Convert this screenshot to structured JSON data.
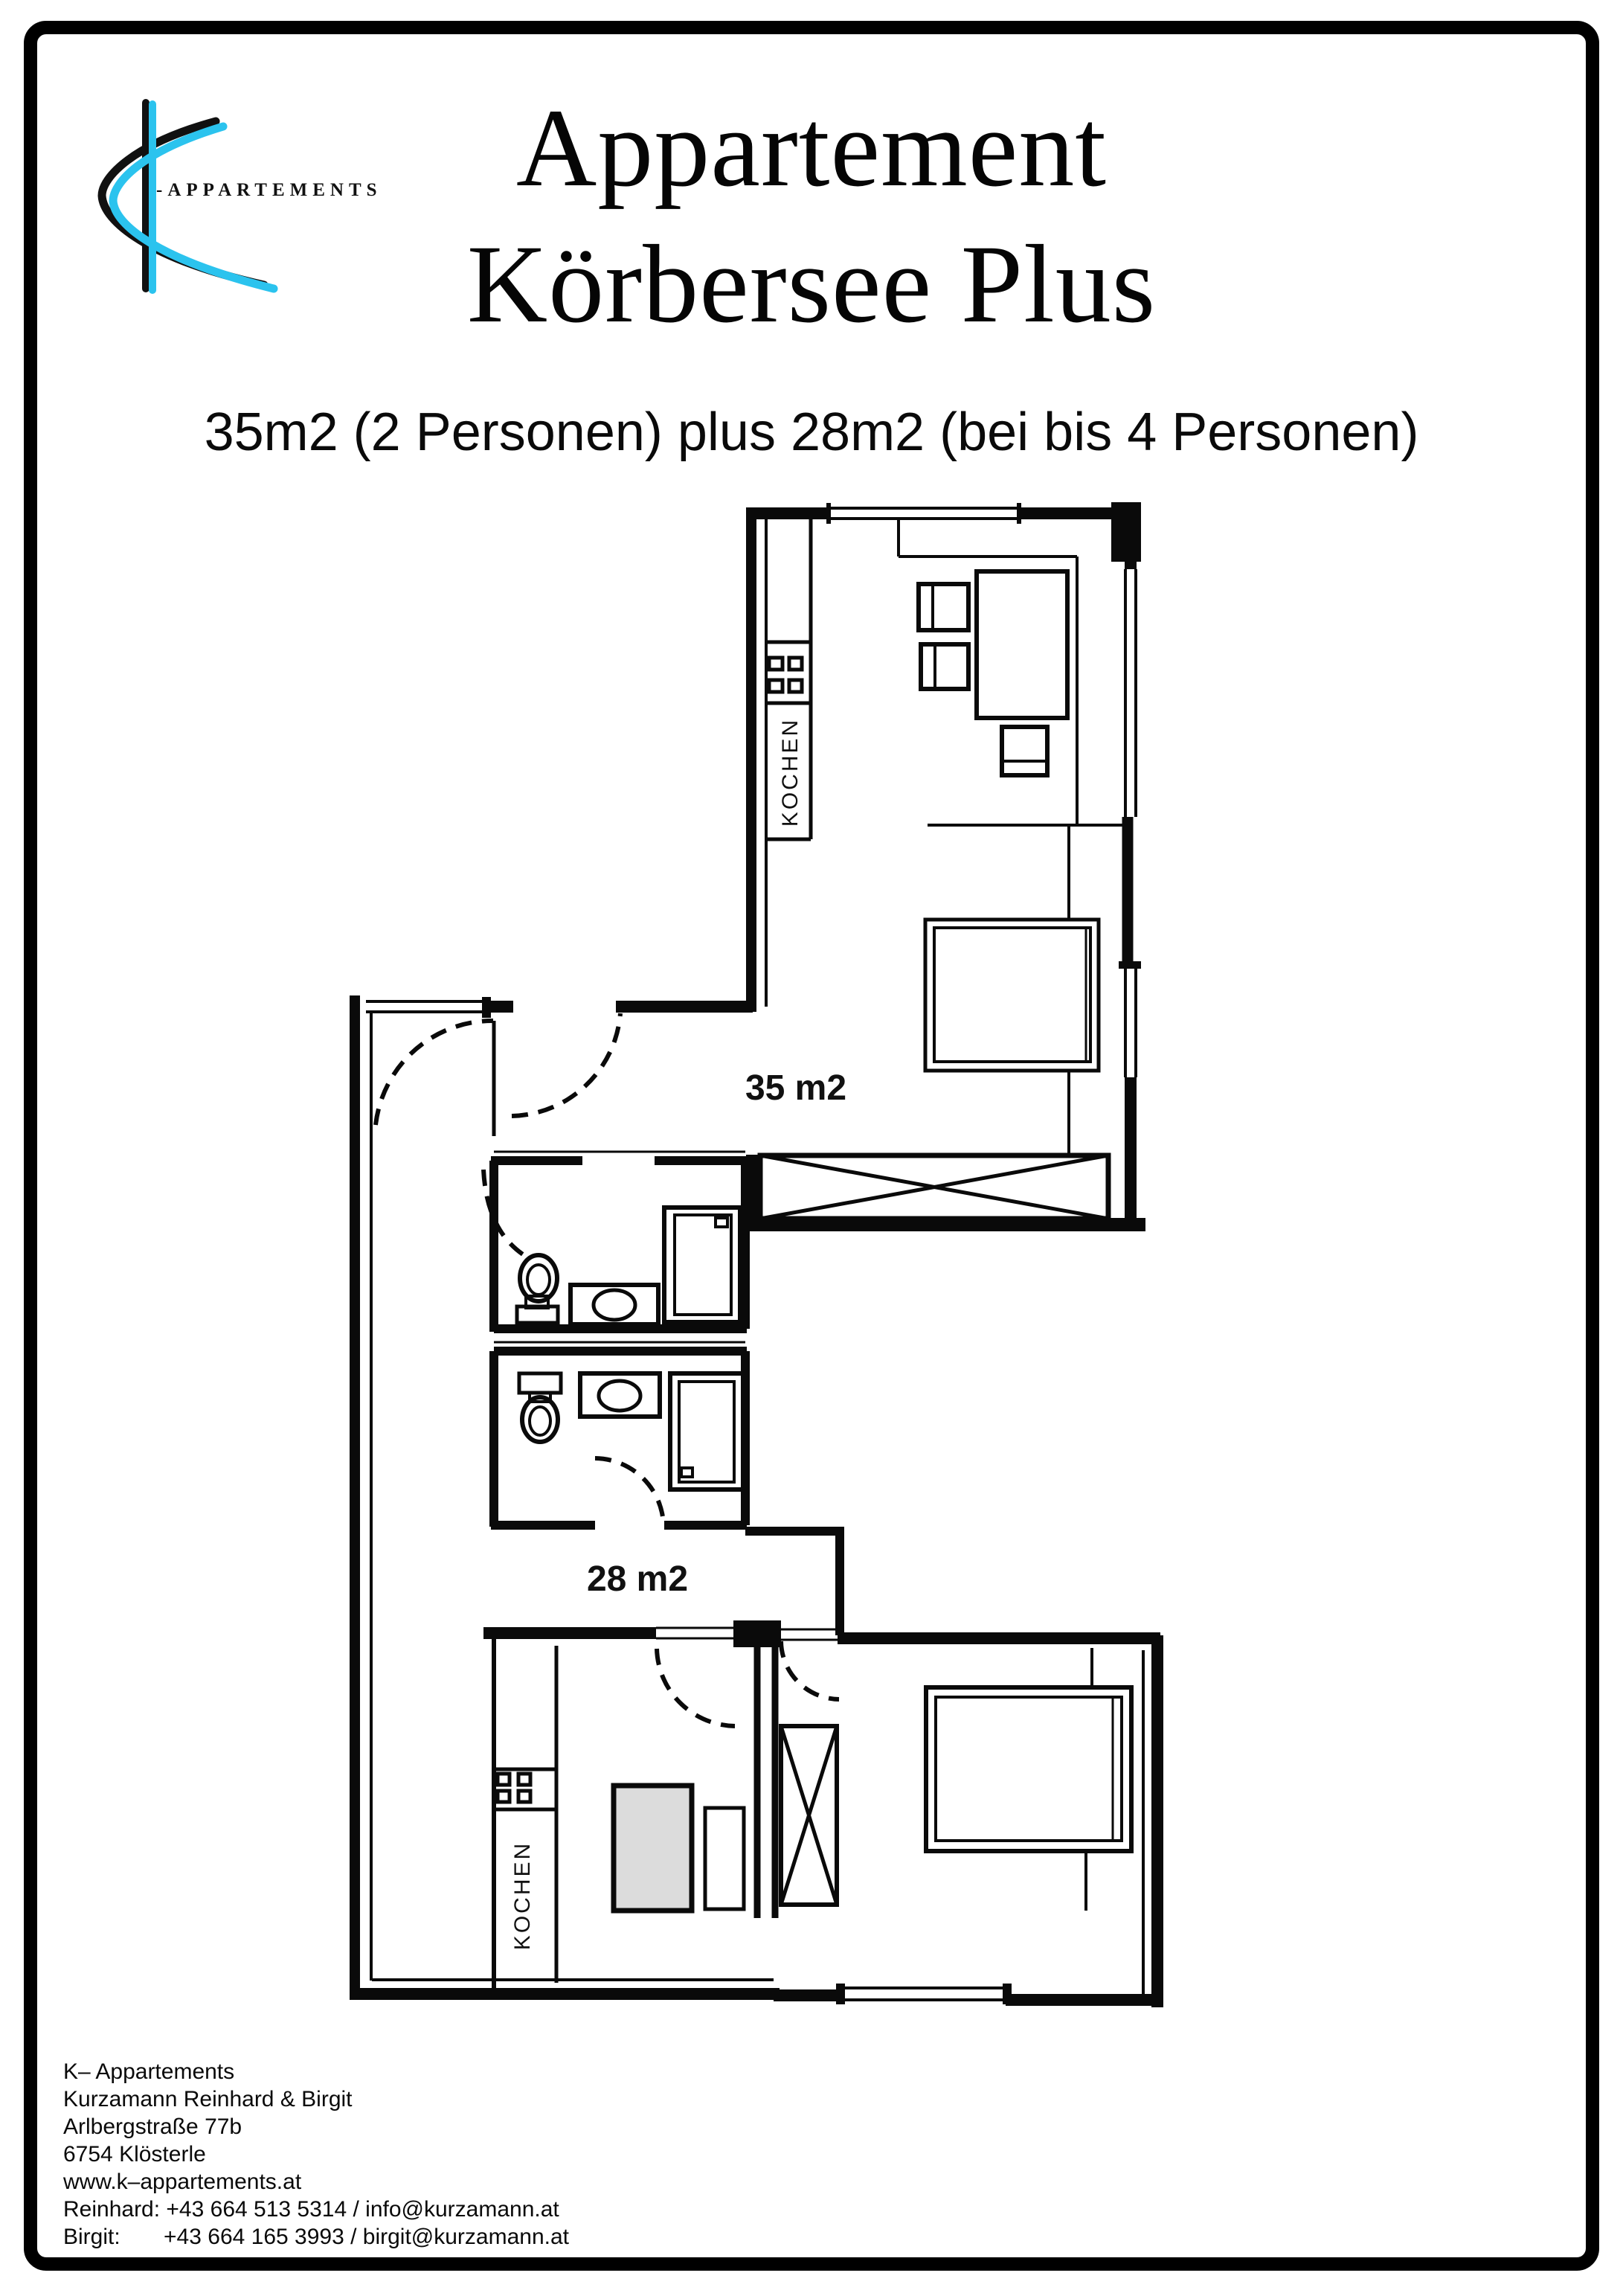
{
  "logo": {
    "brand_text": "-Appartements",
    "accent_color": "#2bc3ee",
    "ink_color": "#111111"
  },
  "header": {
    "title_line1": "Appartement",
    "title_line2": "Körbersee Plus",
    "subtitle": "35m2 (2 Personen) plus 28m2 (bei bis 4 Personen)"
  },
  "floorplan": {
    "unit_upper": {
      "area_label": "35 m2",
      "kitchen_label": "KOCHEN"
    },
    "unit_lower": {
      "area_label": "28 m2",
      "kitchen_label": "KOCHEN"
    },
    "wall_color": "#0a0a0a",
    "table_fill": "#dcdcdc"
  },
  "footer": {
    "lines": [
      "K– Appartements",
      "Kurzamann Reinhard & Birgit",
      "Arlbergstraße 77b",
      "6754 Klösterle",
      "www.k–appartements.at",
      "Reinhard: +43 664 513 5314 / info@kurzamann.at",
      "Birgit:       +43 664 165 3993 / birgit@kurzamann.at"
    ]
  }
}
